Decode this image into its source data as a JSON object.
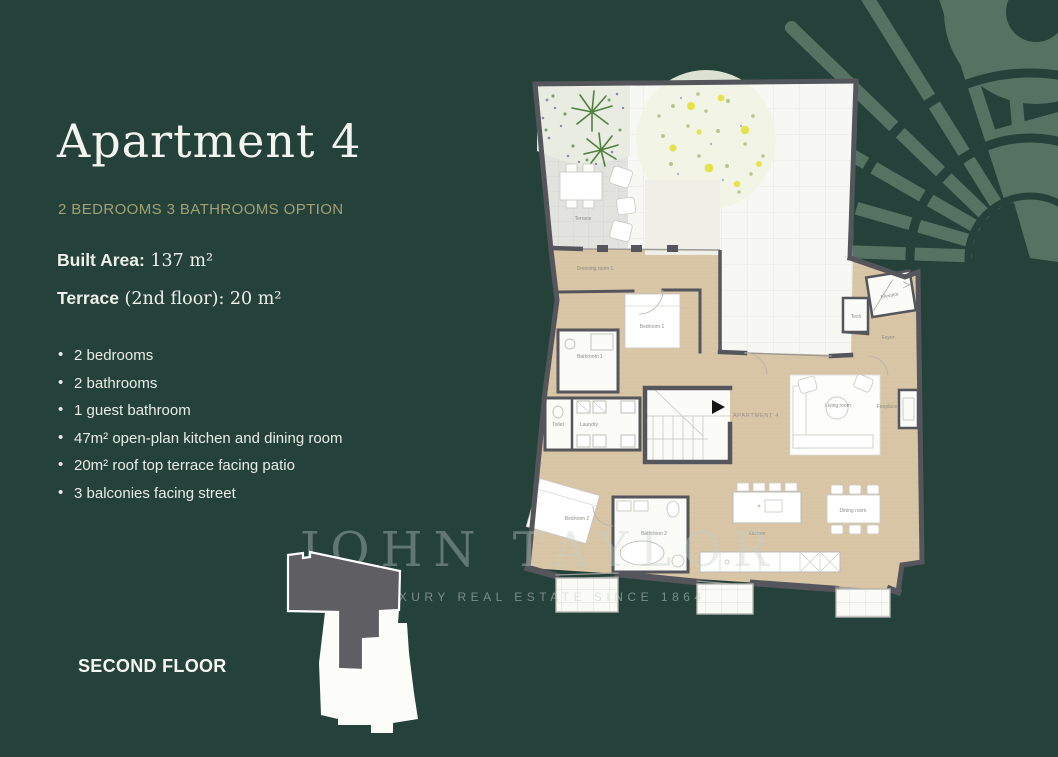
{
  "slide": {
    "title": "Apartment 4",
    "subtitle": "2 BEDROOMS 3 BATHROOMS OPTION",
    "specs": [
      {
        "bold": "Built Area:",
        "rest": " 137 m²"
      },
      {
        "bold": "Terrace",
        "rest": " (2nd floor): 20 m²"
      }
    ],
    "features": [
      "2 bedrooms",
      "2 bathrooms",
      "1 guest bathroom",
      "47m² open-plan kitchen and dining room",
      "20m² roof top terrace facing patio",
      "3 balconies facing street"
    ],
    "floor_label": "SECOND FLOOR"
  },
  "watermark": {
    "brand": "JOHN TAYLOR",
    "tagline": "LUXURY REAL ESTATE SINCE 1864"
  },
  "floorplan": {
    "apartment_label": "APARTMENT 4",
    "rooms": {
      "terrace": "Terrace",
      "dressing_room_1": "Dressing room 1",
      "bedroom_1": "Bedroom 1",
      "bathroom_1": "Bathroom 1",
      "toilet": "Toilet",
      "laundry": "Laundry",
      "bedroom_2": "Bedroom 2",
      "bathroom_2": "Bathroom 2",
      "kitchen": "Kitchen",
      "dining_room": "Dining room",
      "living_room": "Living room",
      "fireplace": "Fireplace",
      "foyer": "Foyer",
      "tech": "Tech",
      "elevator": "Elevator"
    }
  },
  "colors": {
    "background": "#25423a",
    "accent_gold": "#a2a075",
    "pattern_green": "#567263",
    "plan_floor_tan": "#d9c6a7",
    "plan_wall_gray": "#55565c"
  }
}
